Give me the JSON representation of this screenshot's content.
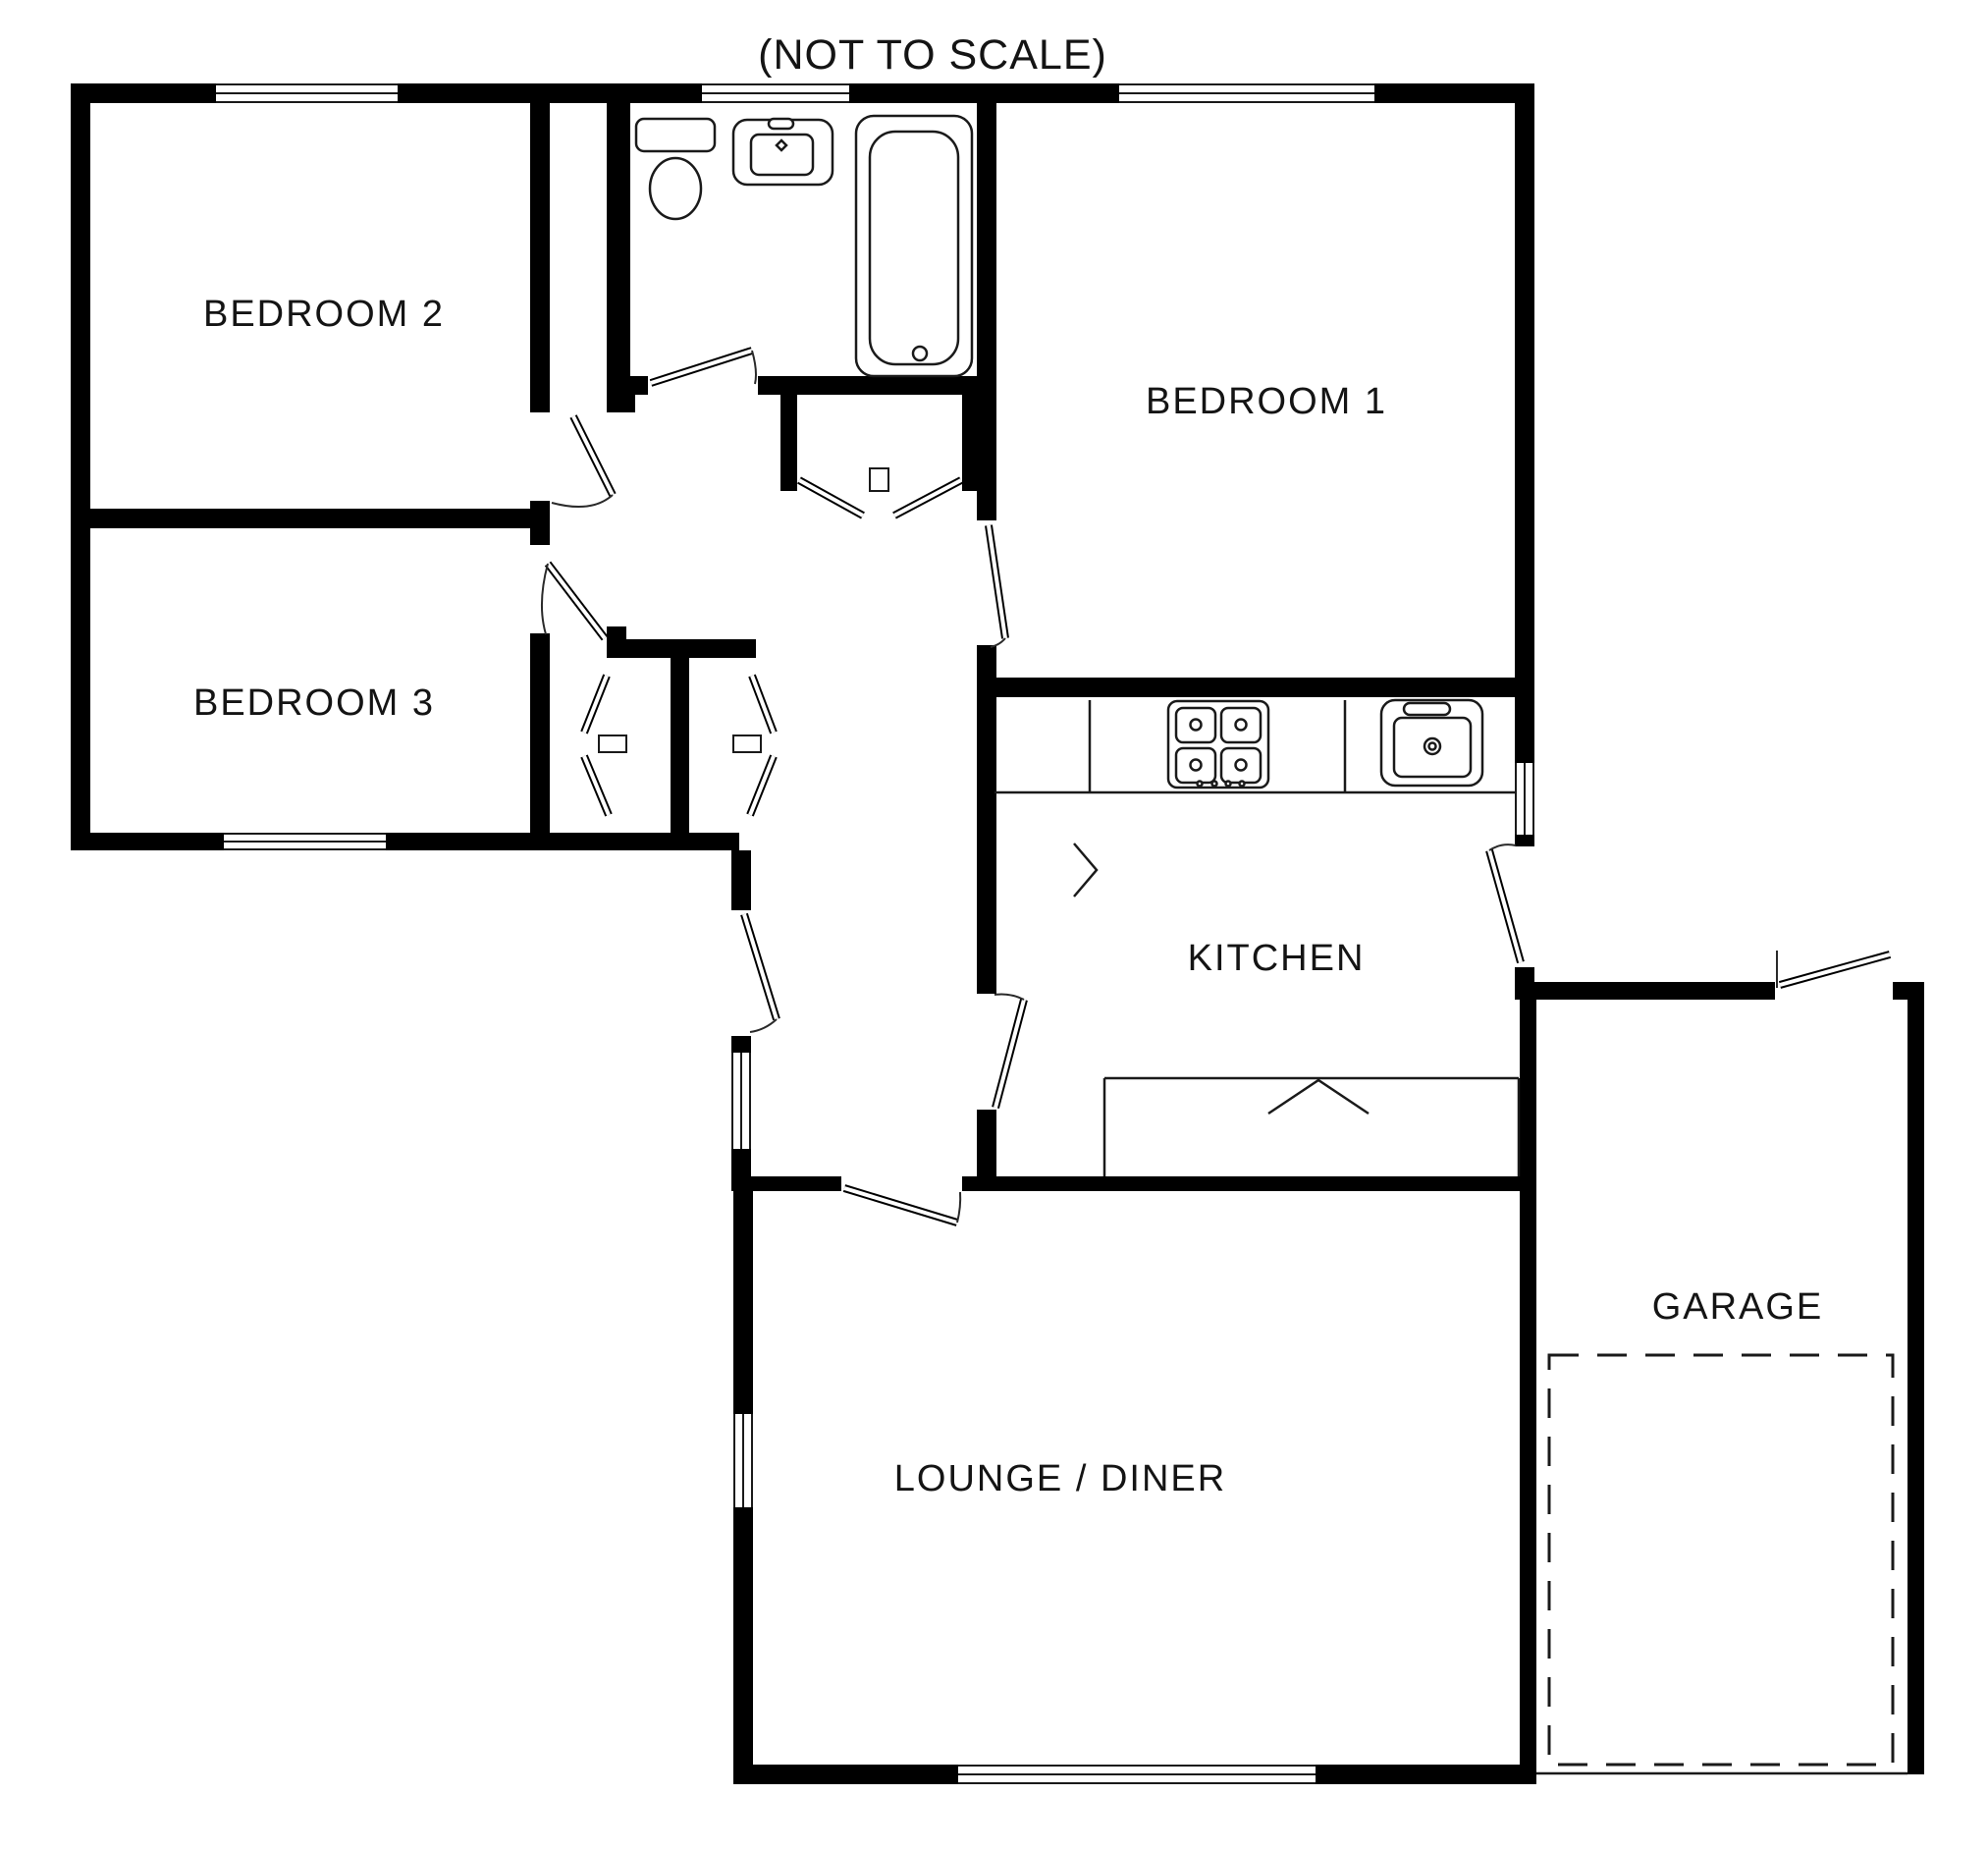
{
  "title": "(NOT TO SCALE)",
  "colors": {
    "wall": "#000000",
    "line": "#1a1a1a",
    "background": "#ffffff"
  },
  "rooms": [
    {
      "id": "bedroom-2",
      "label": "BEDROOM 2"
    },
    {
      "id": "bedroom-3",
      "label": "BEDROOM 3"
    },
    {
      "id": "bedroom-1",
      "label": "BEDROOM 1"
    },
    {
      "id": "kitchen",
      "label": "KITCHEN"
    },
    {
      "id": "lounge-diner",
      "label": "LOUNGE / DINER"
    },
    {
      "id": "garage",
      "label": "GARAGE"
    }
  ],
  "fixtures": [
    {
      "id": "toilet",
      "name": "toilet"
    },
    {
      "id": "wash-basin",
      "name": "wash basin"
    },
    {
      "id": "bathtub",
      "name": "bathtub"
    },
    {
      "id": "hob",
      "name": "four ring hob"
    },
    {
      "id": "kitchen-sink",
      "name": "kitchen sink"
    },
    {
      "id": "worktop",
      "name": "kitchen worktop"
    },
    {
      "id": "garage-bay",
      "name": "garage parking bay dashed outline"
    }
  ]
}
